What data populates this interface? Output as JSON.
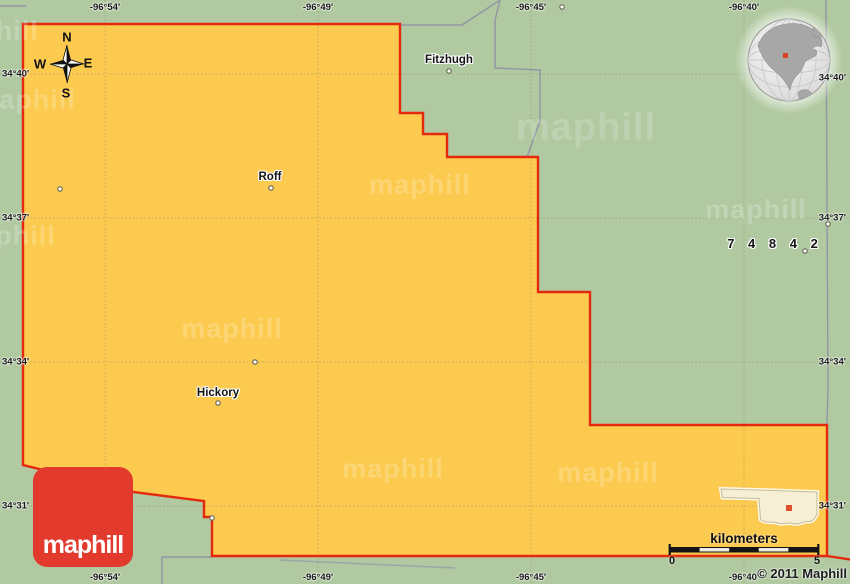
{
  "map_title": {
    "towns": [
      {
        "name": "Fitzhugh"
      },
      {
        "name": "Roff"
      },
      {
        "name": "Hickory"
      }
    ]
  },
  "zip_code_label": "7 4 8 4 2",
  "grid": {
    "lon": [
      "-96°54'",
      "-96°49'",
      "-96°45'",
      "-96°40'"
    ],
    "lat": [
      "34°40'",
      "34°37'",
      "34°34'",
      "34°31'"
    ]
  },
  "compass": {
    "north": "N",
    "south": "S",
    "east": "E",
    "west": "W"
  },
  "scale_bar": {
    "unit_label": "kilometers",
    "start": "0",
    "end": "5"
  },
  "branding": {
    "logo_text": "maphill",
    "watermark_text": "maphill",
    "copyright": "© 2011 Maphill"
  },
  "colors": {
    "county_fill": "#FBCA4F",
    "county_border": "#E5290D",
    "background_green": "#B0C9A0",
    "road_gray": "#9295A6",
    "logo_red": "#E23B2E",
    "inset_fill": "#F6EFD6",
    "location_marker_red": "#D8431F"
  }
}
